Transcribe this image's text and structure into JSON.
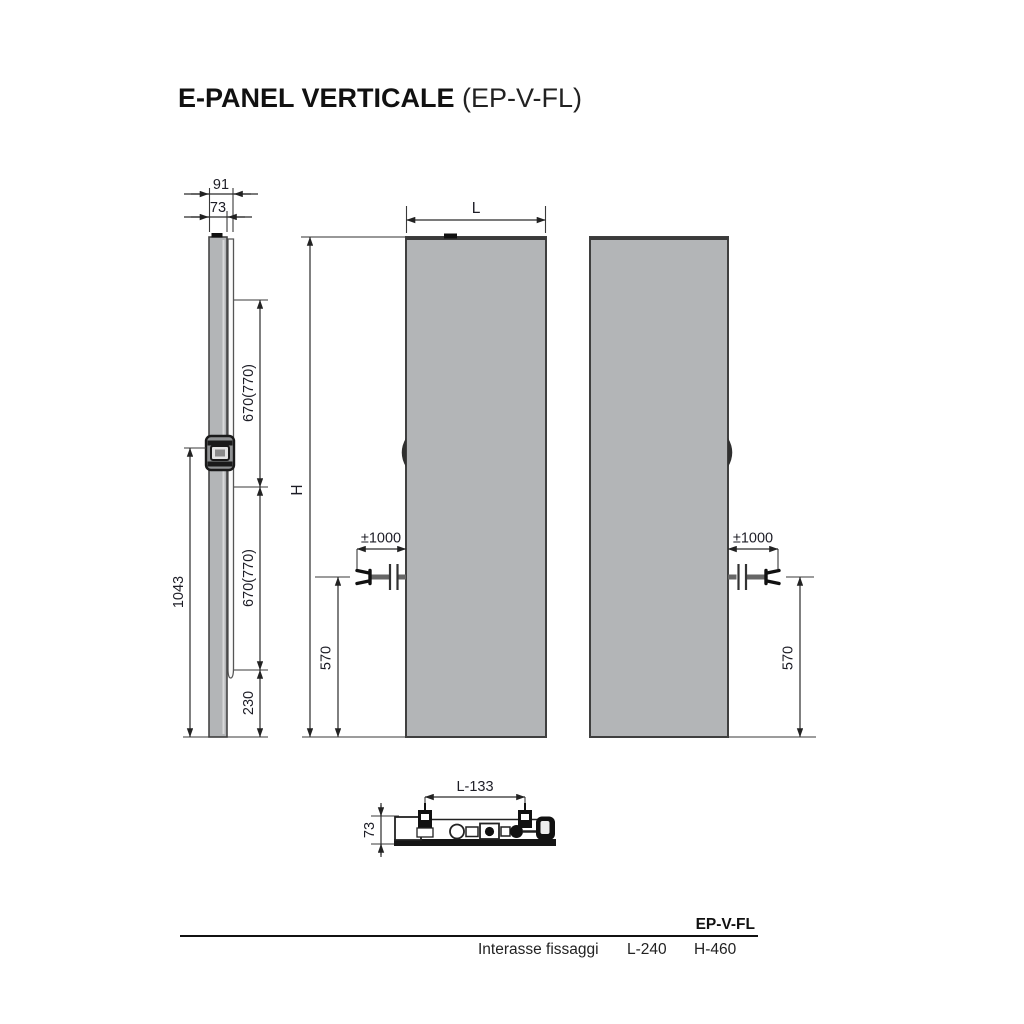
{
  "title": {
    "name": "E-PANEL VERTICALE",
    "code": "(EP-V-FL)"
  },
  "views": {
    "side": {
      "dim_depth_total": "91",
      "dim_depth_panel": "73",
      "dim_upper_span": "670(770)",
      "dim_lower_span": "670(770)",
      "dim_bracket_to_floor": "1043",
      "dim_bottom_offset": "230"
    },
    "front": {
      "dim_width": "L",
      "dim_height": "H",
      "dim_cable_length": "±1000",
      "dim_cable_height": "570"
    },
    "back": {
      "dim_cable_length": "±1000",
      "dim_cable_height": "570"
    },
    "bottom": {
      "dim_fixing_span": "L-133",
      "dim_depth": "73"
    }
  },
  "spec_table": {
    "model": "EP-V-FL",
    "row_label": "Interasse fissaggi",
    "l_value": "L-240",
    "h_value": "H-460"
  },
  "colors": {
    "panel_fill": "#b3b5b7",
    "panel_border": "#3f3f3f",
    "line": "#2b2b2b",
    "text": "#1a1a1a"
  }
}
